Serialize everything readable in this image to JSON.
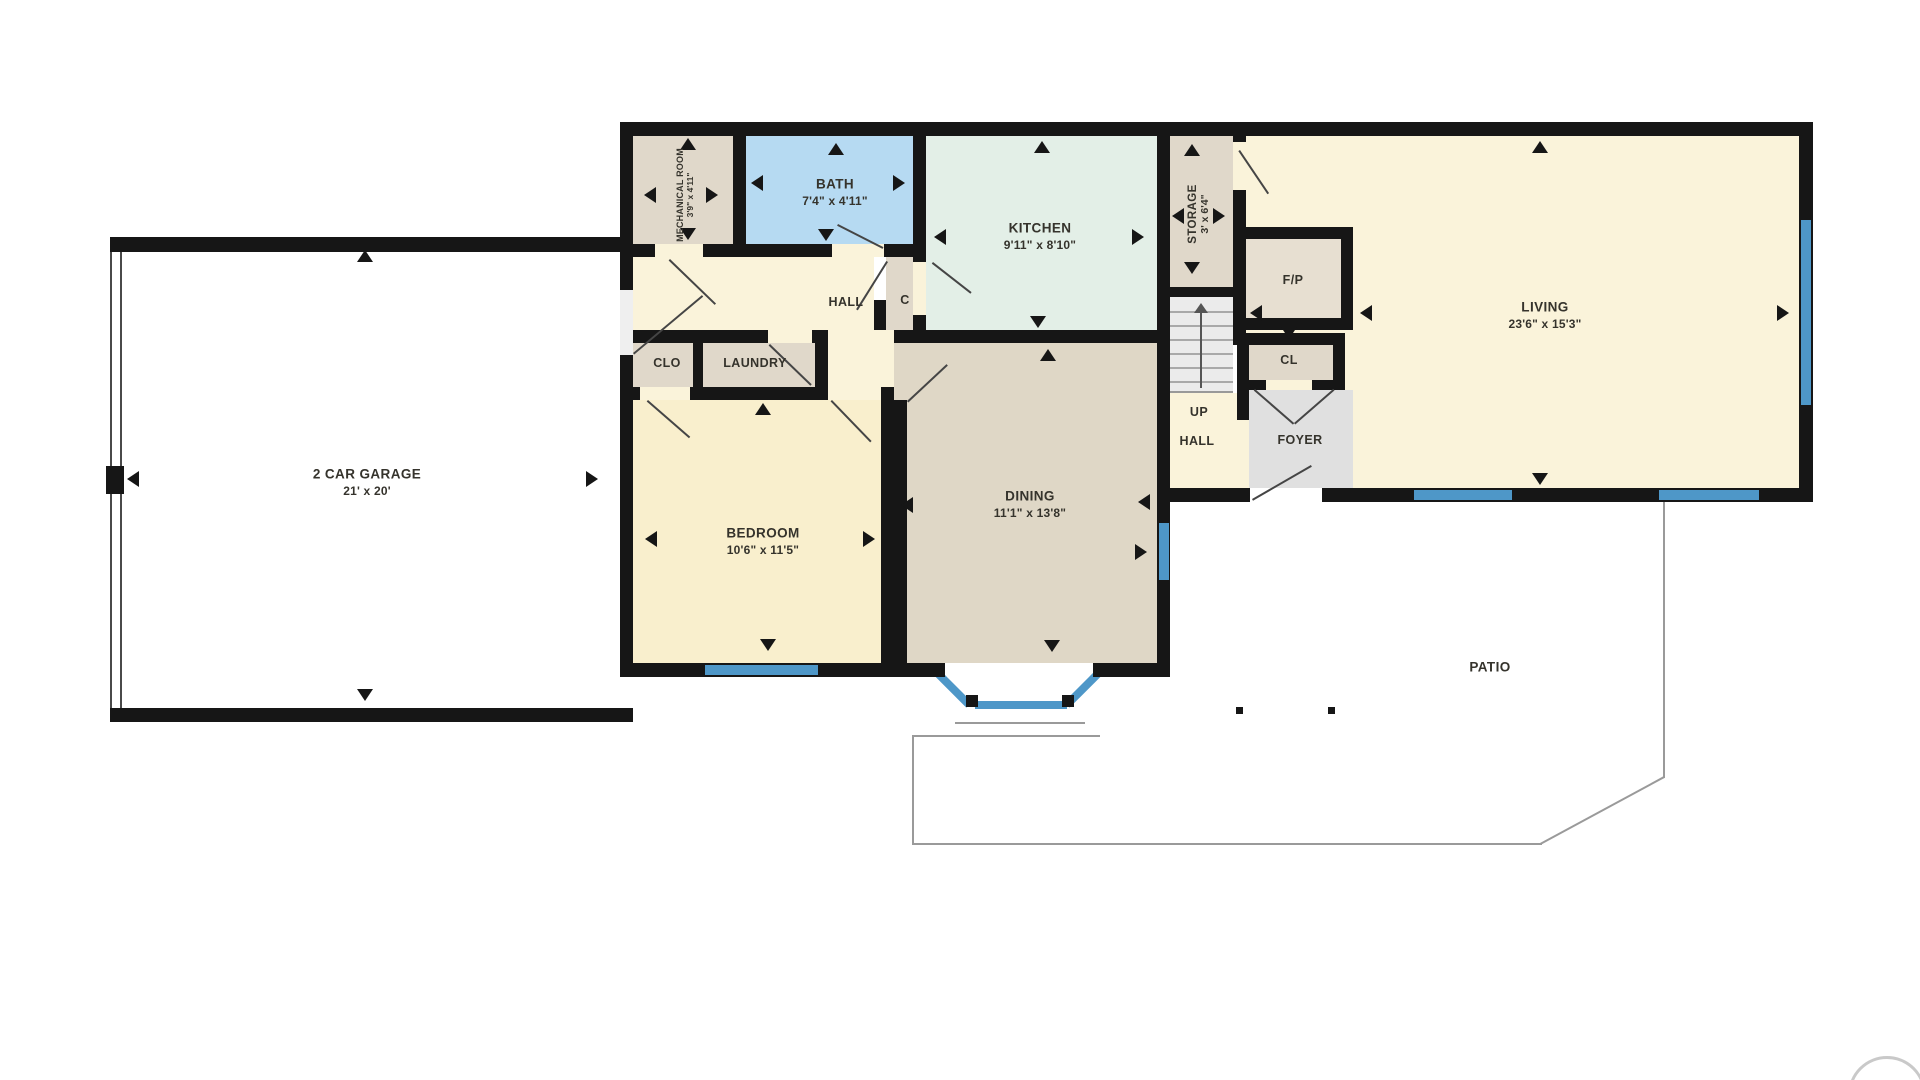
{
  "rooms": {
    "garage": {
      "label": "2 CAR GARAGE",
      "dims": "21' x 20'"
    },
    "mechanical": {
      "label": "MECHANICAL ROOM",
      "dims": "3'9\" x 4'11\""
    },
    "bath": {
      "label": "BATH",
      "dims": "7'4\" x 4'11\""
    },
    "kitchen": {
      "label": "KITCHEN",
      "dims": "9'11\" x 8'10\""
    },
    "storage": {
      "label": "STORAGE",
      "dims": "3' x 6'4\""
    },
    "living": {
      "label": "LIVING",
      "dims": "23'6\" x 15'3\""
    },
    "hall_upper": {
      "label": "HALL"
    },
    "closet_c": {
      "label": "C"
    },
    "clo": {
      "label": "CLO"
    },
    "laundry": {
      "label": "LAUNDRY"
    },
    "bedroom": {
      "label": "BEDROOM",
      "dims": "10'6\" x 11'5\""
    },
    "dining": {
      "label": "DINING",
      "dims": "11'1\" x 13'8\""
    },
    "fireplace": {
      "label": "F/P"
    },
    "closet_cl": {
      "label": "CL"
    },
    "stair_up": {
      "label": "UP"
    },
    "stair_hall": {
      "label": "HALL"
    },
    "foyer": {
      "label": "FOYER"
    },
    "patio": {
      "label": "PATIO"
    }
  },
  "colors": {
    "wall": "#161616",
    "window": "#4e97c8",
    "cream": "#faf3da",
    "bedroomFill": "#f9efcd",
    "bath": "#b6daf2",
    "kitchen": "#e3efe7",
    "dining": "#dfd7c6",
    "beige": "#e0d8ca",
    "foyer": "#e0e0e0",
    "stairs": "#ebebeb",
    "fp": "#e7dfd1",
    "patioLine": "#9a9a9a",
    "text": "#35332c"
  }
}
